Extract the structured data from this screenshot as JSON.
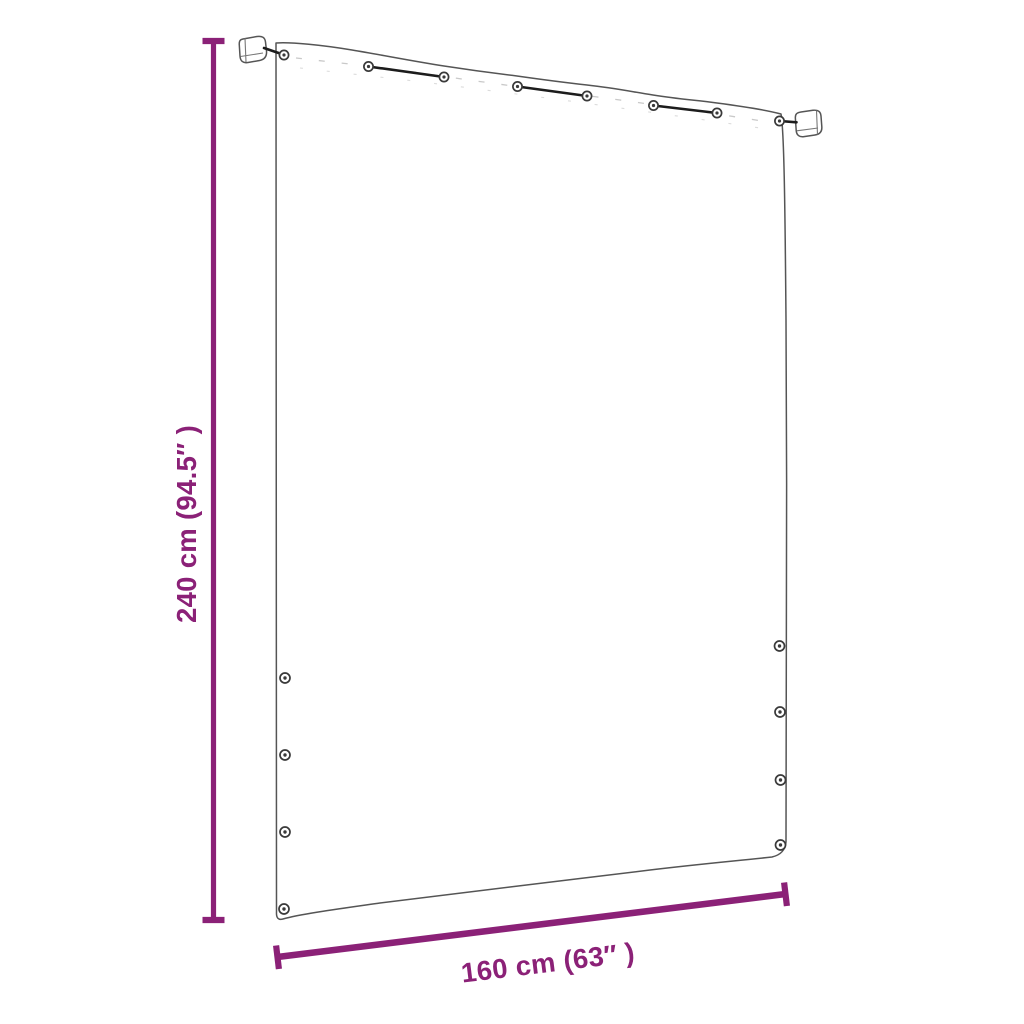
{
  "diagram": {
    "background_color": "#ffffff",
    "accent_color": "#8b2177",
    "outline_color": "#555555",
    "dimensions": {
      "height": {
        "label": "240 cm (94.5″ )"
      },
      "width": {
        "label": "160 cm (63″ )"
      }
    },
    "grommets": {
      "top_count": 8,
      "left_count": 4,
      "right_count": 4
    },
    "brackets": {
      "count": 2
    }
  }
}
